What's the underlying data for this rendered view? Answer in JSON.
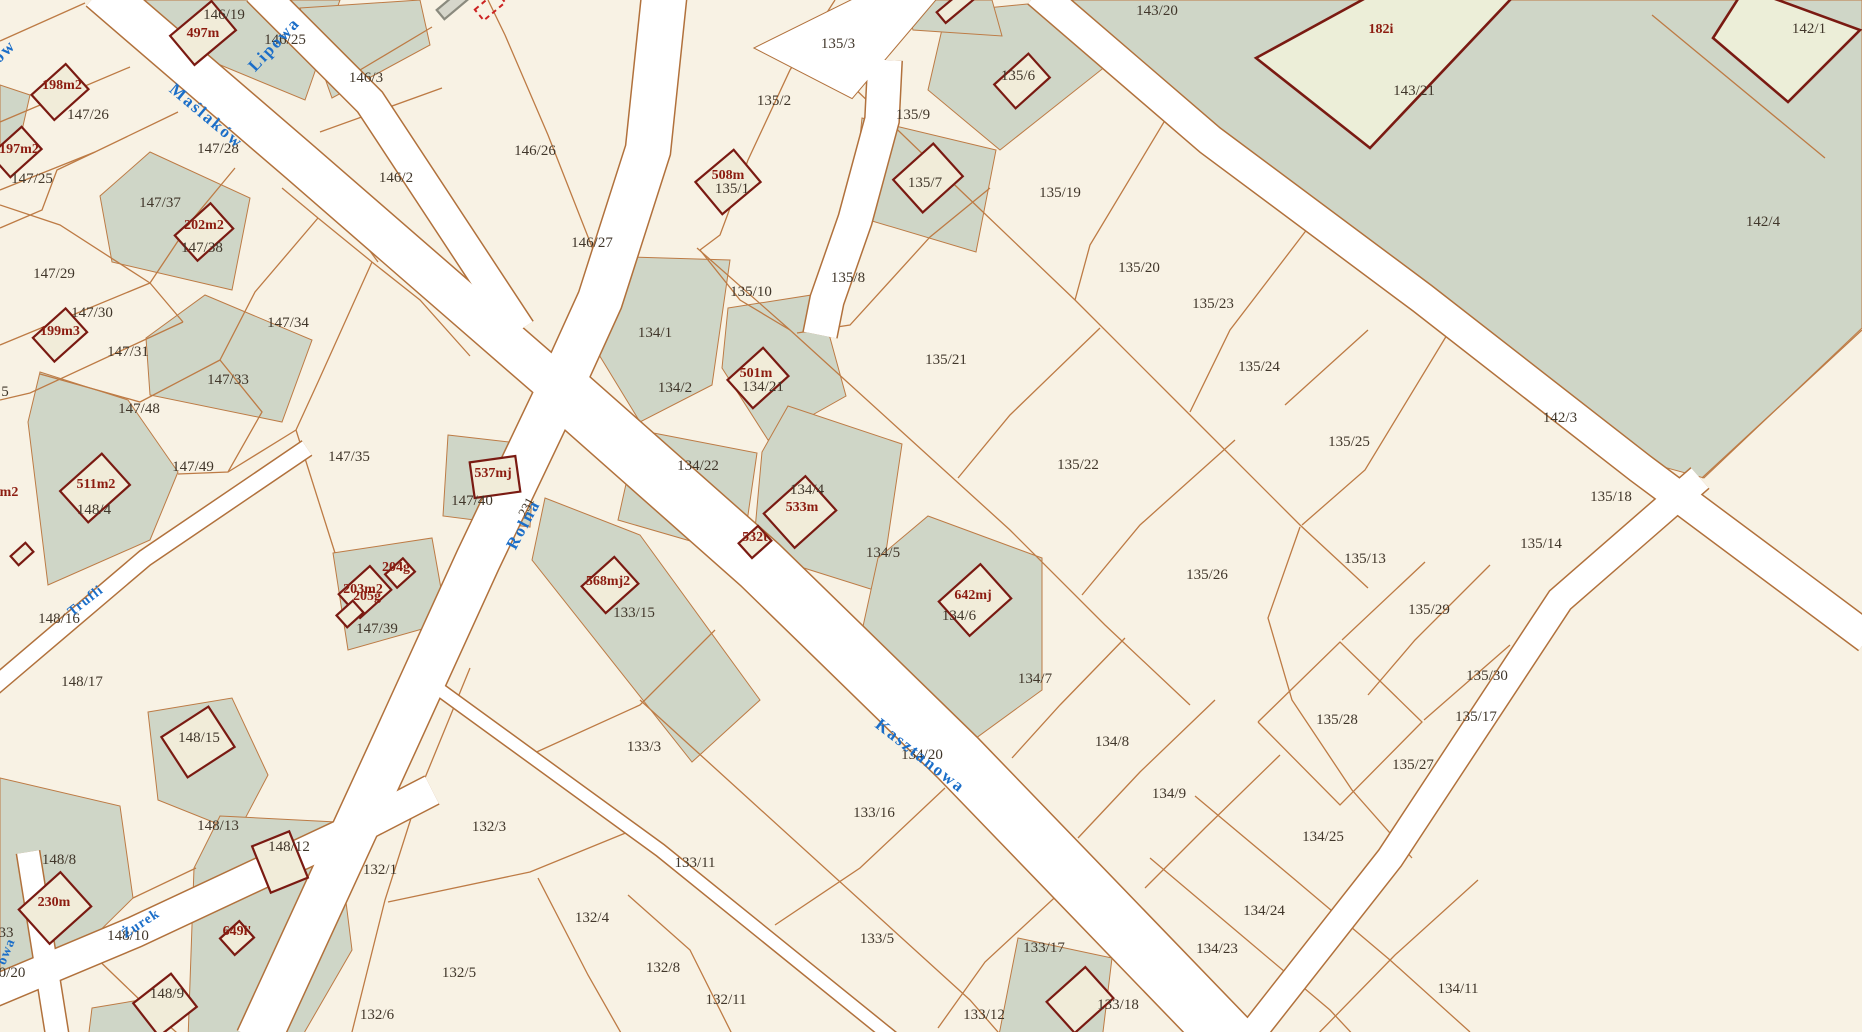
{
  "map": {
    "type": "cadastral-parcel-map",
    "description": "Polish cadastral map with parcel numbers, buildings and street names"
  },
  "colors": {
    "background": "#f8f2e4",
    "road_fill": "#ffffff",
    "road_casing": "#b1713c",
    "parcel_line": "#bd7b45",
    "built_area_fill": "#cfd6c7",
    "building_fill": "#f1ecd9",
    "building_outline": "#7a1a12",
    "big_building_fill": "#eceed8",
    "parcel_label": "#40362a",
    "building_label": "#8c1c10",
    "street_label": "#1b6ec8"
  },
  "streets": [
    {
      "name": "Maślaków",
      "x": 203,
      "y": 120,
      "rot": 40
    },
    {
      "name": "Lipowa",
      "x": 278,
      "y": 48,
      "rot": -47
    },
    {
      "name": "ów",
      "x": 8,
      "y": 55,
      "rot": -45
    },
    {
      "name": "Rolna",
      "x": 528,
      "y": 527,
      "rot": -62
    },
    {
      "name": "Kasztanowa",
      "x": 917,
      "y": 760,
      "rot": 38
    },
    {
      "name": "Trufli",
      "x": 88,
      "y": 604,
      "rot": -38,
      "small": true
    },
    {
      "name": "Żurek",
      "x": 143,
      "y": 927,
      "rot": -33,
      "small": true
    },
    {
      "name": "owa",
      "x": 10,
      "y": 953,
      "rot": -68,
      "small": true
    }
  ],
  "parcel_labels": [
    {
      "id": "146/19",
      "x": 224,
      "y": 19
    },
    {
      "id": "146/25",
      "x": 285,
      "y": 44
    },
    {
      "id": "146/3",
      "x": 366,
      "y": 82
    },
    {
      "id": "147/26",
      "x": 88,
      "y": 119
    },
    {
      "id": "147/28",
      "x": 218,
      "y": 153
    },
    {
      "id": "146/2",
      "x": 396,
      "y": 182
    },
    {
      "id": "147/25",
      "x": 32,
      "y": 183
    },
    {
      "id": "147/37",
      "x": 160,
      "y": 207
    },
    {
      "id": "147/38",
      "x": 202,
      "y": 252
    },
    {
      "id": "147/29",
      "x": 54,
      "y": 278
    },
    {
      "id": "147/30",
      "x": 92,
      "y": 317
    },
    {
      "id": "147/34",
      "x": 288,
      "y": 327
    },
    {
      "id": "147/31",
      "x": 128,
      "y": 356
    },
    {
      "id": "147/33",
      "x": 228,
      "y": 384
    },
    {
      "id": "147/48",
      "x": 139,
      "y": 413
    },
    {
      "id": "5",
      "x": 5,
      "y": 396
    },
    {
      "id": "147/49",
      "x": 193,
      "y": 471
    },
    {
      "id": "147/35",
      "x": 349,
      "y": 461
    },
    {
      "id": "148/4",
      "x": 94,
      "y": 514
    },
    {
      "id": "147/40",
      "x": 472,
      "y": 505
    },
    {
      "id": "231",
      "x": 530,
      "y": 509,
      "rot": -62,
      "small": true
    },
    {
      "id": "148/16",
      "x": 59,
      "y": 623
    },
    {
      "id": "147/39",
      "x": 377,
      "y": 633
    },
    {
      "id": "148/17",
      "x": 82,
      "y": 686
    },
    {
      "id": "148/15",
      "x": 199,
      "y": 742
    },
    {
      "id": "148/13",
      "x": 218,
      "y": 830
    },
    {
      "id": "148/12",
      "x": 289,
      "y": 851
    },
    {
      "id": "148/8",
      "x": 59,
      "y": 864
    },
    {
      "id": "132/1",
      "x": 380,
      "y": 874
    },
    {
      "id": "33",
      "x": 6,
      "y": 937
    },
    {
      "id": "148/10",
      "x": 128,
      "y": 940
    },
    {
      "id": "0/20",
      "x": 12,
      "y": 977
    },
    {
      "id": "148/9",
      "x": 167,
      "y": 998
    },
    {
      "id": "132/6",
      "x": 377,
      "y": 1019
    },
    {
      "id": "146/26",
      "x": 535,
      "y": 155
    },
    {
      "id": "146/27",
      "x": 592,
      "y": 247
    },
    {
      "id": "135/2",
      "x": 774,
      "y": 105
    },
    {
      "id": "135/3",
      "x": 838,
      "y": 48
    },
    {
      "id": "135/1",
      "x": 732,
      "y": 193
    },
    {
      "id": "135/10",
      "x": 751,
      "y": 296
    },
    {
      "id": "135/9",
      "x": 913,
      "y": 119
    },
    {
      "id": "135/6",
      "x": 1018,
      "y": 80
    },
    {
      "id": "135/7",
      "x": 925,
      "y": 187
    },
    {
      "id": "135/8",
      "x": 848,
      "y": 282
    },
    {
      "id": "135/19",
      "x": 1060,
      "y": 197
    },
    {
      "id": "143/20",
      "x": 1157,
      "y": 15
    },
    {
      "id": "143/21",
      "x": 1414,
      "y": 95
    },
    {
      "id": "142/1",
      "x": 1809,
      "y": 33
    },
    {
      "id": "142/4",
      "x": 1763,
      "y": 226
    },
    {
      "id": "135/20",
      "x": 1139,
      "y": 272
    },
    {
      "id": "135/23",
      "x": 1213,
      "y": 308
    },
    {
      "id": "135/21",
      "x": 946,
      "y": 364
    },
    {
      "id": "135/24",
      "x": 1259,
      "y": 371
    },
    {
      "id": "135/25",
      "x": 1349,
      "y": 446
    },
    {
      "id": "142/3",
      "x": 1560,
      "y": 422
    },
    {
      "id": "135/18",
      "x": 1611,
      "y": 501
    },
    {
      "id": "135/14",
      "x": 1541,
      "y": 548
    },
    {
      "id": "135/22",
      "x": 1078,
      "y": 469
    },
    {
      "id": "134/1",
      "x": 655,
      "y": 337
    },
    {
      "id": "134/2",
      "x": 675,
      "y": 392
    },
    {
      "id": "134/21",
      "x": 763,
      "y": 391
    },
    {
      "id": "134/22",
      "x": 698,
      "y": 470
    },
    {
      "id": "134/4",
      "x": 807,
      "y": 494
    },
    {
      "id": "134/5",
      "x": 883,
      "y": 557
    },
    {
      "id": "133/15",
      "x": 634,
      "y": 617
    },
    {
      "id": "134/6",
      "x": 959,
      "y": 620
    },
    {
      "id": "134/7",
      "x": 1035,
      "y": 683
    },
    {
      "id": "135/26",
      "x": 1207,
      "y": 579
    },
    {
      "id": "135/13",
      "x": 1365,
      "y": 563
    },
    {
      "id": "135/29",
      "x": 1429,
      "y": 614
    },
    {
      "id": "135/30",
      "x": 1487,
      "y": 680
    },
    {
      "id": "135/28",
      "x": 1337,
      "y": 724
    },
    {
      "id": "135/27",
      "x": 1413,
      "y": 769
    },
    {
      "id": "134/8",
      "x": 1112,
      "y": 746
    },
    {
      "id": "134/9",
      "x": 1169,
      "y": 798
    },
    {
      "id": "134/20",
      "x": 922,
      "y": 759
    },
    {
      "id": "133/16",
      "x": 874,
      "y": 817
    },
    {
      "id": "133/3",
      "x": 644,
      "y": 751
    },
    {
      "id": "133/11",
      "x": 695,
      "y": 867
    },
    {
      "id": "132/3",
      "x": 489,
      "y": 831
    },
    {
      "id": "132/4",
      "x": 592,
      "y": 922
    },
    {
      "id": "132/5",
      "x": 459,
      "y": 977
    },
    {
      "id": "132/8",
      "x": 663,
      "y": 972
    },
    {
      "id": "132/11",
      "x": 726,
      "y": 1004
    },
    {
      "id": "133/5",
      "x": 877,
      "y": 943
    },
    {
      "id": "133/12",
      "x": 984,
      "y": 1019
    },
    {
      "id": "133/17",
      "x": 1044,
      "y": 952
    },
    {
      "id": "133/18",
      "x": 1118,
      "y": 1009
    },
    {
      "id": "134/25",
      "x": 1323,
      "y": 841
    },
    {
      "id": "134/24",
      "x": 1264,
      "y": 915
    },
    {
      "id": "134/23",
      "x": 1217,
      "y": 953
    },
    {
      "id": "134/11",
      "x": 1458,
      "y": 993
    },
    {
      "id": "135/17",
      "x": 1476,
      "y": 721
    }
  ],
  "building_labels": [
    {
      "id": "497m",
      "x": 203,
      "y": 37
    },
    {
      "id": "198m2",
      "x": 62,
      "y": 89
    },
    {
      "id": "197m2",
      "x": 19,
      "y": 153
    },
    {
      "id": "202m2",
      "x": 204,
      "y": 229
    },
    {
      "id": "199m3",
      "x": 60,
      "y": 335
    },
    {
      "id": "511m2",
      "x": 96,
      "y": 488
    },
    {
      "id": "m2",
      "x": 9,
      "y": 496
    },
    {
      "id": "537mj",
      "x": 493,
      "y": 477
    },
    {
      "id": "203m2",
      "x": 363,
      "y": 593
    },
    {
      "id": "204g",
      "x": 396,
      "y": 571
    },
    {
      "id": "205g",
      "x": 367,
      "y": 600
    },
    {
      "id": "230m",
      "x": 54,
      "y": 906
    },
    {
      "id": "649i'",
      "x": 237,
      "y": 935
    },
    {
      "id": "508m",
      "x": 728,
      "y": 179
    },
    {
      "id": "501m",
      "x": 756,
      "y": 377
    },
    {
      "id": "533m",
      "x": 802,
      "y": 511
    },
    {
      "id": "532t",
      "x": 755,
      "y": 541
    },
    {
      "id": "568mj2",
      "x": 608,
      "y": 585
    },
    {
      "id": "642mj",
      "x": 973,
      "y": 599
    },
    {
      "id": "182i",
      "x": 1381,
      "y": 33
    }
  ]
}
